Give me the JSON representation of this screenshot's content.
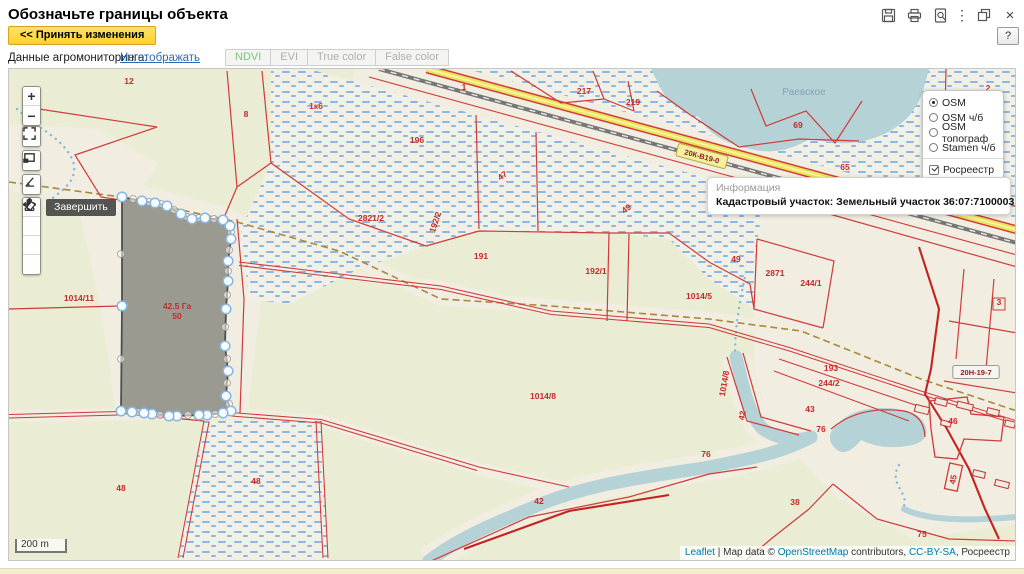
{
  "window": {
    "title": "Обозначьте границы объекта",
    "help_label": "?"
  },
  "toolbar": {
    "accept_button": "<< Принять изменения",
    "agro_label": "Данные агромониторинга:",
    "agro_link": "Не отображать",
    "tabs": [
      {
        "label": "NDVI",
        "active": true
      },
      {
        "label": "EVI",
        "active": false
      },
      {
        "label": "True color",
        "active": false
      },
      {
        "label": "False color",
        "active": false
      }
    ]
  },
  "layers_panel": {
    "base_layers": [
      {
        "label": "OSM",
        "selected": true
      },
      {
        "label": "OSM ч/б",
        "selected": false
      },
      {
        "label": "OSM топограф",
        "selected": false
      },
      {
        "label": "Stamen ч/б",
        "selected": false
      }
    ],
    "overlays": [
      {
        "label": "Росреестр",
        "checked": true
      }
    ]
  },
  "info_box": {
    "header": "Информация",
    "text": "Кадастровый участок: Земельный участок 36:07:7100003:50"
  },
  "map": {
    "tooltip": "Завершить",
    "scale_label": "200 m",
    "lake_label": "Раевское",
    "area_label": "42.5 Га",
    "area_sublabel": "50",
    "area_label_pos": {
      "x": 168,
      "y": 240
    },
    "lake_label_pos": {
      "x": 795,
      "y": 26
    },
    "road_shields": [
      {
        "t": "20К-В19-0",
        "x": 693,
        "y": 87,
        "r": 15,
        "bg": "#f5efa0",
        "border": "#b8a838"
      },
      {
        "t": "20Н-19-7",
        "x": 967,
        "y": 303,
        "r": 0,
        "bg": "#f4f4f0",
        "border": "#9a9a9a"
      }
    ],
    "parcel_labels": [
      {
        "t": "12",
        "x": 120,
        "y": 15
      },
      {
        "t": "8",
        "x": 237,
        "y": 48
      },
      {
        "t": "196",
        "x": 408,
        "y": 74
      },
      {
        "t": "1к6",
        "x": 307,
        "y": 40,
        "s": 7
      },
      {
        "t": "1",
        "x": 455,
        "y": 21
      },
      {
        "t": "47",
        "x": 495,
        "y": 109,
        "r": -35
      },
      {
        "t": "49",
        "x": 619,
        "y": 142,
        "r": -35
      },
      {
        "t": "217",
        "x": 575,
        "y": 25
      },
      {
        "t": "219",
        "x": 624,
        "y": 36
      },
      {
        "t": "2",
        "x": 979,
        "y": 22
      },
      {
        "t": "69",
        "x": 789,
        "y": 59
      },
      {
        "t": "65",
        "x": 836,
        "y": 101
      },
      {
        "t": "2821/2",
        "x": 362,
        "y": 152
      },
      {
        "t": "192/2",
        "x": 429,
        "y": 154,
        "r": -72
      },
      {
        "t": "191",
        "x": 472,
        "y": 190
      },
      {
        "t": "192/1",
        "x": 587,
        "y": 205
      },
      {
        "t": "1014/5",
        "x": 690,
        "y": 230
      },
      {
        "t": "49",
        "x": 727,
        "y": 193
      },
      {
        "t": "2871",
        "x": 766,
        "y": 207
      },
      {
        "t": "244/1",
        "x": 802,
        "y": 217
      },
      {
        "t": "1014/11",
        "x": 70,
        "y": 232
      },
      {
        "t": "193",
        "x": 822,
        "y": 302
      },
      {
        "t": "244/2",
        "x": 820,
        "y": 317
      },
      {
        "t": "1014/8",
        "x": 534,
        "y": 330
      },
      {
        "t": "1014/8",
        "x": 718,
        "y": 315,
        "r": -80
      },
      {
        "t": "42",
        "x": 736,
        "y": 347,
        "r": -80,
        "s": 7
      },
      {
        "t": "43",
        "x": 801,
        "y": 343
      },
      {
        "t": "76",
        "x": 697,
        "y": 388
      },
      {
        "t": "76",
        "x": 812,
        "y": 363
      },
      {
        "t": "46",
        "x": 944,
        "y": 355,
        "s": 7.5
      },
      {
        "t": "45",
        "x": 947,
        "y": 411,
        "r": -80,
        "s": 7.5
      },
      {
        "t": "75",
        "x": 913,
        "y": 468
      },
      {
        "t": "38",
        "x": 786,
        "y": 436
      },
      {
        "t": "42",
        "x": 530,
        "y": 435
      },
      {
        "t": "48",
        "x": 112,
        "y": 422
      },
      {
        "t": "48",
        "x": 247,
        "y": 415
      },
      {
        "t": "3",
        "x": 990,
        "y": 236
      }
    ],
    "polygon": {
      "vertices": [
        [
          113,
          128
        ],
        [
          133,
          132
        ],
        [
          146,
          134
        ],
        [
          158,
          137
        ],
        [
          172,
          145
        ],
        [
          183,
          150
        ],
        [
          196,
          149
        ],
        [
          214,
          151
        ],
        [
          221,
          157
        ],
        [
          222,
          170
        ],
        [
          219,
          192
        ],
        [
          219,
          212
        ],
        [
          217,
          240
        ],
        [
          216,
          277
        ],
        [
          219,
          302
        ],
        [
          217,
          327
        ],
        [
          222,
          342
        ],
        [
          214,
          344
        ],
        [
          198,
          346
        ],
        [
          190,
          346
        ],
        [
          168,
          347
        ],
        [
          160,
          347
        ],
        [
          143,
          345
        ],
        [
          135,
          344
        ],
        [
          123,
          343
        ],
        [
          112,
          342
        ],
        [
          113,
          237
        ]
      ],
      "midpoints": [
        [
          124,
          130
        ],
        [
          140,
          133
        ],
        [
          152,
          135
        ],
        [
          165,
          141
        ],
        [
          178,
          148
        ],
        [
          190,
          149
        ],
        [
          205,
          150
        ],
        [
          222,
          163
        ],
        [
          220,
          181
        ],
        [
          219,
          202
        ],
        [
          218,
          226
        ],
        [
          216,
          258
        ],
        [
          218,
          290
        ],
        [
          218,
          314
        ],
        [
          220,
          335
        ],
        [
          218,
          343
        ],
        [
          206,
          345
        ],
        [
          179,
          346
        ],
        [
          151,
          346
        ],
        [
          129,
          343
        ],
        [
          112,
          290
        ],
        [
          112,
          185
        ]
      ]
    },
    "attribution": {
      "leaflet": "Leaflet",
      "sep1": " | Map data © ",
      "osm": "OpenStreetMap",
      "sep2": " contributors, ",
      "cc": "CC-BY-SA",
      "sep3": ", Росреестр"
    }
  },
  "colors": {
    "accept_yellow": "#ffd12e",
    "link_blue": "#2e6db4",
    "ndvi_green": "#7cc47c",
    "cadastral_red": "#d03a3a",
    "water": "#b5d2d6",
    "marsh_dash": "#8cb6e2",
    "polygon_gray": "#8b8b83"
  }
}
